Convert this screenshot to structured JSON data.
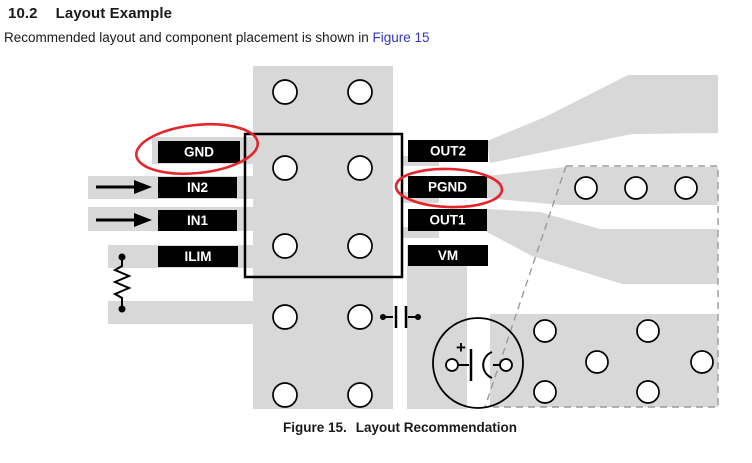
{
  "header": {
    "section_number": "10.2",
    "section_title": "Layout Example"
  },
  "intro": {
    "text": "Recommended layout and component placement is shown in ",
    "link_text": "Figure 15"
  },
  "figure": {
    "caption_label": "Figure 15.",
    "caption_title": "Layout Recommendation",
    "left_pins": [
      {
        "label": "GND"
      },
      {
        "label": "IN2"
      },
      {
        "label": "IN1"
      },
      {
        "label": "ILIM"
      }
    ],
    "right_pins": [
      {
        "label": "OUT2"
      },
      {
        "label": "PGND"
      },
      {
        "label": "OUT1"
      },
      {
        "label": "VM"
      }
    ],
    "annotated_pins": [
      "GND",
      "PGND"
    ],
    "battery_plus_label": "+",
    "colors": {
      "annotation_red": "#e4252b",
      "trace_gray": "#d8d8d8",
      "link_blue": "#3333cc"
    }
  }
}
